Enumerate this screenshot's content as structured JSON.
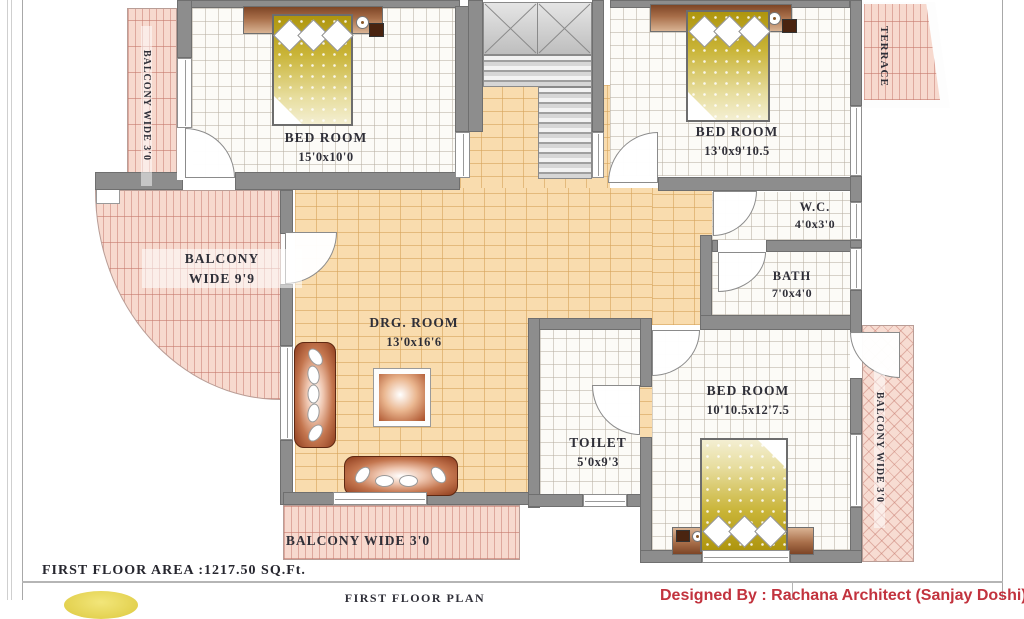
{
  "plan": {
    "rooms": {
      "bedroom_tl": {
        "name": "BED ROOM",
        "dims": "15'0x10'0"
      },
      "bedroom_tr": {
        "name": "BED ROOM",
        "dims": "13'0x9'10.5"
      },
      "bedroom_br": {
        "name": "BED  ROOM",
        "dims": "10'10.5x12'7.5"
      },
      "drg_room": {
        "name": "DRG. ROOM",
        "dims": "13'0x16'6"
      },
      "wc": {
        "name": "W.C.",
        "dims": "4'0x3'0"
      },
      "bath": {
        "name": "BATH",
        "dims": "7'0x4'0"
      },
      "toilet": {
        "name": "TOILET",
        "dims": "5'0x9'3"
      }
    },
    "outdoor": {
      "balcony_left": "BALCONY WIDE 3'0",
      "balcony_curved_line1": "BALCONY",
      "balcony_curved_line2": "WIDE 9'9",
      "balcony_bottom": "BALCONY  WIDE  3'0",
      "balcony_right": "BALCONY WIDE 3'0",
      "terrace": "TERRACE"
    },
    "colors": {
      "wall": "#8d8d8d",
      "tile_floor": "#fcfbf7",
      "living_floor": "#f9dcae",
      "balcony_floor": "#f7d9ce",
      "bed_spread": "#c9b437",
      "furniture_wood": "#a84c26",
      "credit_red": "#c2333e"
    }
  },
  "footer": {
    "area_text": "FIRST  FLOOR  AREA :1217.50 SQ.Ft.",
    "plan_title": "FIRST  FLOOR  PLAN",
    "designer_credit": "Designed By : Rachana Architect (Sanjay  Doshi)"
  }
}
